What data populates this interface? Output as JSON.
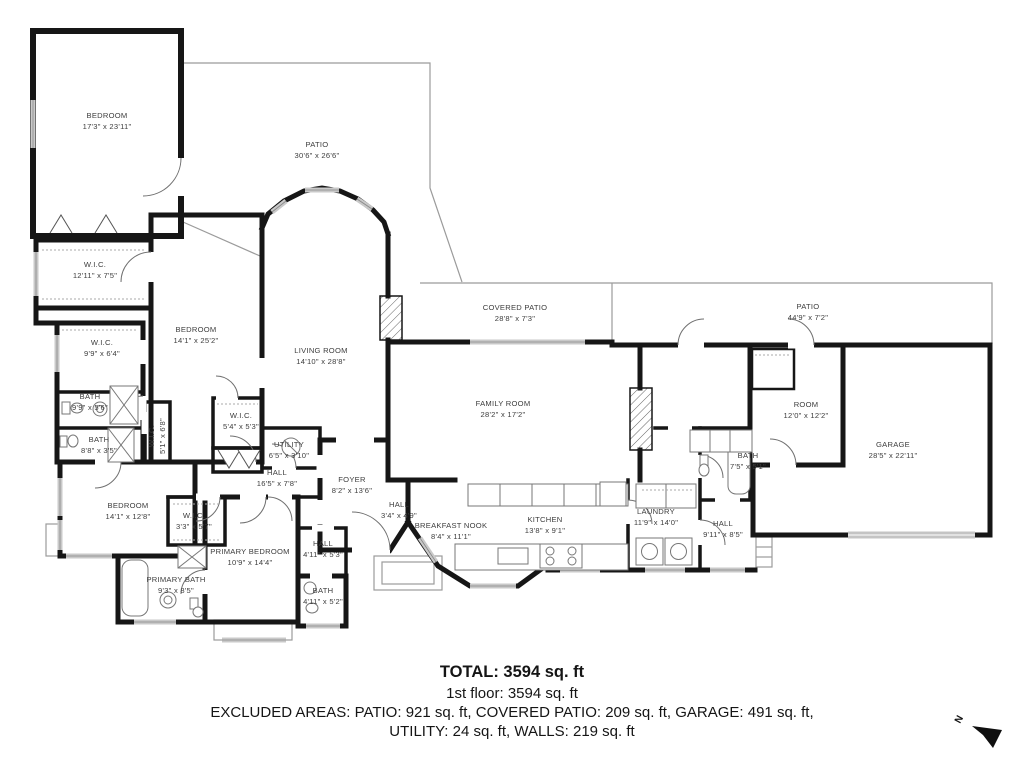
{
  "plan": {
    "rooms": [
      {
        "id": "bedroom-top-left",
        "label": "BEDROOM",
        "dims": "17'3\" x 23'11\"",
        "x": 107,
        "y": 121
      },
      {
        "id": "patio-top",
        "label": "PATIO",
        "dims": "30'6\" x 26'6\"",
        "x": 317,
        "y": 150
      },
      {
        "id": "wic-large",
        "label": "W.I.C.",
        "dims": "12'11\" x 7'5\"",
        "x": 95,
        "y": 270
      },
      {
        "id": "bedroom-left",
        "label": "BEDROOM",
        "dims": "14'1\" x 25'2\"",
        "x": 196,
        "y": 335
      },
      {
        "id": "wic-2",
        "label": "W.I.C.",
        "dims": "9'9\" x 6'4\"",
        "x": 102,
        "y": 348
      },
      {
        "id": "living-room",
        "label": "LIVING ROOM",
        "dims": "14'10\" x 28'8\"",
        "x": 321,
        "y": 356
      },
      {
        "id": "covered-patio",
        "label": "COVERED PATIO",
        "dims": "28'8\" x 7'3\"",
        "x": 515,
        "y": 313
      },
      {
        "id": "patio-right",
        "label": "PATIO",
        "dims": "44'9\" x 7'2\"",
        "x": 808,
        "y": 312
      },
      {
        "id": "bath-1",
        "label": "BATH",
        "dims": "9'9\" x 5'6\"",
        "x": 90,
        "y": 402
      },
      {
        "id": "bath-2",
        "label": "BATH",
        "dims": "8'8\" x 3'5\"",
        "x": 99,
        "y": 445
      },
      {
        "id": "wic-hall",
        "label": "W.I.C.",
        "dims": "5'1\" x 6'8\"",
        "x": 157,
        "y": 436,
        "vertical": true
      },
      {
        "id": "wic-4",
        "label": "W.I.C.",
        "dims": "5'4\" x 5'3\"",
        "x": 241,
        "y": 421
      },
      {
        "id": "utility",
        "label": "UTILITY",
        "dims": "6'5\" x 3'10\"",
        "x": 289,
        "y": 450
      },
      {
        "id": "family-room",
        "label": "FAMILY ROOM",
        "dims": "28'2\" x 17'2\"",
        "x": 503,
        "y": 409
      },
      {
        "id": "room",
        "label": "ROOM",
        "dims": "12'0\" x 12'2\"",
        "x": 806,
        "y": 410
      },
      {
        "id": "garage",
        "label": "GARAGE",
        "dims": "28'5\" x 22'11\"",
        "x": 893,
        "y": 450
      },
      {
        "id": "bath-3",
        "label": "BATH",
        "dims": "7'5\" x 5'1\"",
        "x": 748,
        "y": 461
      },
      {
        "id": "hall-1",
        "label": "HALL",
        "dims": "16'5\" x 7'8\"",
        "x": 277,
        "y": 478
      },
      {
        "id": "foyer",
        "label": "FOYER",
        "dims": "8'2\" x 13'6\"",
        "x": 352,
        "y": 485
      },
      {
        "id": "bedroom-bottom-left",
        "label": "BEDROOM",
        "dims": "14'1\" x 12'8\"",
        "x": 128,
        "y": 511
      },
      {
        "id": "wic-5",
        "label": "W.I.C.",
        "dims": "3'3\" x 5'7\"",
        "x": 194,
        "y": 521
      },
      {
        "id": "hall-2",
        "label": "HALL",
        "dims": "3'4\" x 4'9\"",
        "x": 399,
        "y": 510
      },
      {
        "id": "breakfast-nook",
        "label": "BREAKFAST NOOK",
        "dims": "8'4\" x 11'1\"",
        "x": 451,
        "y": 531
      },
      {
        "id": "kitchen",
        "label": "KITCHEN",
        "dims": "13'8\" x 9'1\"",
        "x": 545,
        "y": 525
      },
      {
        "id": "laundry",
        "label": "LAUNDRY",
        "dims": "11'9\" x 14'0\"",
        "x": 656,
        "y": 517
      },
      {
        "id": "hall-3",
        "label": "HALL",
        "dims": "9'11\" x 8'5\"",
        "x": 723,
        "y": 529
      },
      {
        "id": "primary-bedroom",
        "label": "PRIMARY BEDROOM",
        "dims": "10'9\" x 14'4\"",
        "x": 250,
        "y": 557
      },
      {
        "id": "hall-4",
        "label": "HALL",
        "dims": "4'11\" x 5'3\"",
        "x": 323,
        "y": 549
      },
      {
        "id": "primary-bath",
        "label": "PRIMARY BATH",
        "dims": "9'3\" x 8'5\"",
        "x": 176,
        "y": 585
      },
      {
        "id": "bath-4",
        "label": "BATH",
        "dims": "4'11\" x 5'2\"",
        "x": 323,
        "y": 596
      }
    ],
    "summary": {
      "total": "TOTAL: 3594 sq. ft",
      "floor": "1st floor: 3594 sq. ft",
      "excluded_line1": "EXCLUDED AREAS: PATIO: 921 sq. ft, COVERED PATIO: 209 sq. ft, GARAGE: 491 sq. ft,",
      "excluded_line2": "UTILITY: 24 sq. ft, WALLS: 219 sq. ft"
    },
    "compass": {
      "label": "N"
    },
    "colors": {
      "wall": "#161616",
      "patio_line": "#9b9b9b",
      "window": "#c9c9c9",
      "label_text": "#3d3d3d"
    }
  }
}
